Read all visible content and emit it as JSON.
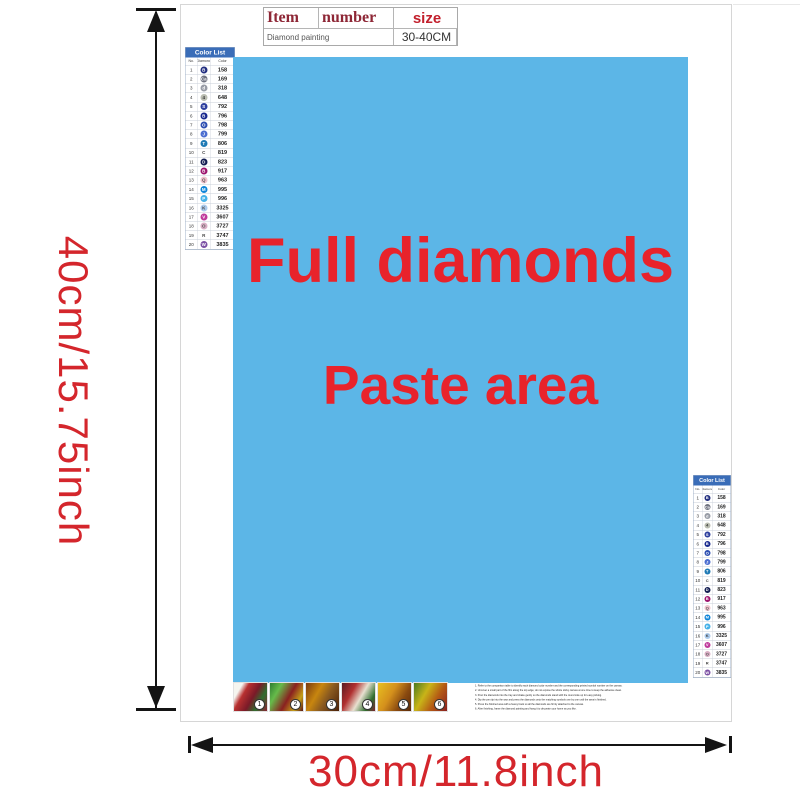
{
  "labels": {
    "height": "40cm/15.75inch",
    "width": "30cm/11.8inch"
  },
  "spec_table": {
    "item": "Item",
    "number": "number",
    "size": "size",
    "product": "Diamond painting",
    "size_value": "30-40CM"
  },
  "paste_area": {
    "line1": "Full diamonds",
    "line2": "Paste area",
    "bg_color": "#5cb6e7",
    "text_color": "#e8232b"
  },
  "color_list": {
    "title": "Color List",
    "col_no": "No.",
    "col_diamond": "Diamond",
    "col_color": "Color",
    "rows": [
      {
        "no": "1",
        "symbol": "B",
        "code": "158",
        "bg": "#232f80",
        "fg": "#ffffff"
      },
      {
        "no": "2",
        "symbol": "Ca",
        "code": "169",
        "bg": "#6f7280",
        "fg": "#ffffff"
      },
      {
        "no": "3",
        "symbol": "d",
        "code": "318",
        "bg": "#989ca6",
        "fg": "#ffffff"
      },
      {
        "no": "4",
        "symbol": "4",
        "code": "648",
        "bg": "#b9bcb0",
        "fg": "#333333"
      },
      {
        "no": "5",
        "symbol": "S",
        "code": "792",
        "bg": "#2e3f9e",
        "fg": "#ffffff"
      },
      {
        "no": "6",
        "symbol": "B",
        "code": "796",
        "bg": "#1a2a8e",
        "fg": "#ffffff"
      },
      {
        "no": "7",
        "symbol": "O",
        "code": "798",
        "bg": "#2d4fb2",
        "fg": "#ffffff"
      },
      {
        "no": "8",
        "symbol": "J",
        "code": "799",
        "bg": "#4c6ed0",
        "fg": "#ffffff"
      },
      {
        "no": "9",
        "symbol": "T",
        "code": "806",
        "bg": "#1f7ab5",
        "fg": "#ffffff"
      },
      {
        "no": "10",
        "symbol": "C",
        "code": "819",
        "bg": "transparent",
        "fg": "#444444"
      },
      {
        "no": "11",
        "symbol": "D",
        "code": "823",
        "bg": "#131d52",
        "fg": "#ffffff"
      },
      {
        "no": "12",
        "symbol": "B",
        "code": "917",
        "bg": "#9e146e",
        "fg": "#ffffff"
      },
      {
        "no": "13",
        "symbol": "Q",
        "code": "963",
        "bg": "#f0c3cd",
        "fg": "#555555"
      },
      {
        "no": "14",
        "symbol": "M",
        "code": "995",
        "bg": "#0e84d8",
        "fg": "#ffffff"
      },
      {
        "no": "15",
        "symbol": "P",
        "code": "996",
        "bg": "#45b1e8",
        "fg": "#ffffff"
      },
      {
        "no": "16",
        "symbol": "K",
        "code": "3325",
        "bg": "#abcaec",
        "fg": "#444444"
      },
      {
        "no": "17",
        "symbol": "V",
        "code": "3607",
        "bg": "#bf3a9b",
        "fg": "#ffffff"
      },
      {
        "no": "18",
        "symbol": "O",
        "code": "3727",
        "bg": "#d9aec4",
        "fg": "#555555"
      },
      {
        "no": "19",
        "symbol": "R",
        "code": "3747",
        "bg": "transparent",
        "fg": "#444444"
      },
      {
        "no": "20",
        "symbol": "W",
        "code": "3835",
        "bg": "#7b50a4",
        "fg": "#ffffff"
      }
    ]
  },
  "steps": [
    {
      "num": "1",
      "gradient": "linear-gradient(120deg,#f5f5f0 0%,#f5f5f0 18%,#b83030 32%,#7a1a28 55%,#2f6e2f 75%,#8b2433 100%)"
    },
    {
      "num": "2",
      "gradient": "linear-gradient(120deg,#2e7d32 0%,#66bb4a 25%,#8a2020 55%,#c4a018 80%,#5a1515 100%)"
    },
    {
      "num": "3",
      "gradient": "linear-gradient(120deg,#7a3a10 0%,#c8860f 35%,#8a5a20 60%,#4a2008 100%)"
    },
    {
      "num": "4",
      "gradient": "linear-gradient(120deg,#5a1a20 0%,#b03030 30%,#e8e0d0 55%,#2f6e2f 80%,#7a2430 100%)"
    },
    {
      "num": "5",
      "gradient": "linear-gradient(120deg,#e8c020 0%,#d4901c 40%,#8a4a10 70%,#5a2a08 100%)"
    },
    {
      "num": "6",
      "gradient": "linear-gradient(120deg,#4a7a20 0%,#c8b418 35%,#b45a14 65%,#8a2020 100%)"
    }
  ],
  "instructions": [
    {
      "text": "1. Refer to the comparison table to identify each diamond color number and the corresponding printed symbol number on the canvas."
    },
    {
      "text": "2. Uncover a small part of the film along the top edge; do not expose the whole sticky canvas at one time to keep the adhesive clean."
    },
    {
      "text": "3. Pour the diamonds into the tray and shake gently so the diamonds stand with the round side up for easy picking."
    },
    {
      "text": "4. Dip the pen tip into the wax and press the diamonds onto the matching symbols one by one until the area is finished."
    },
    {
      "text": "5. Press the finished area with a heavy book so all the diamonds are firmly attached to the canvas."
    },
    {
      "text": "6. After finishing, frame the diamond painting and hang it to decorate your home as you like."
    }
  ]
}
